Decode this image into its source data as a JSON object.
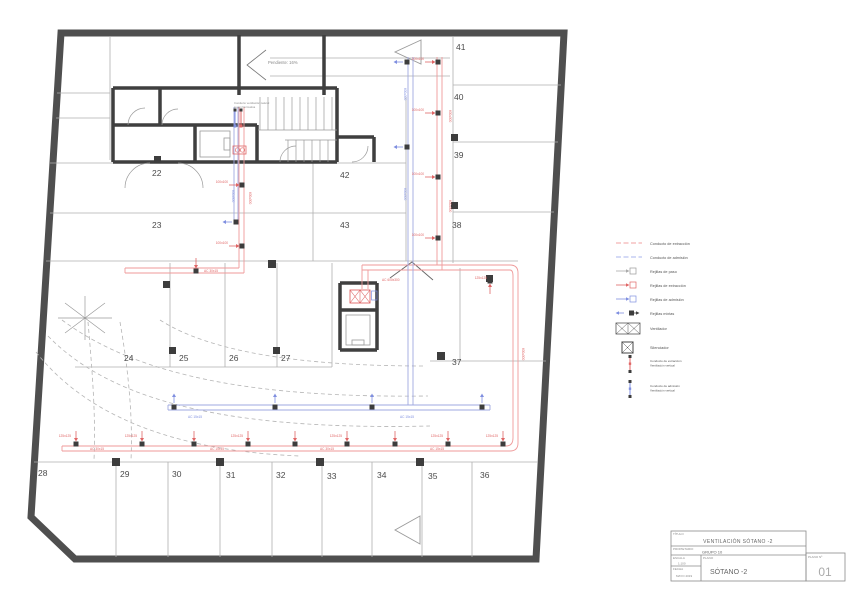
{
  "drawing": {
    "spaces": [
      "22",
      "23",
      "24",
      "25",
      "26",
      "27",
      "28",
      "29",
      "30",
      "31",
      "32",
      "33",
      "34",
      "35",
      "36",
      "37",
      "38",
      "39",
      "40",
      "41",
      "42",
      "43"
    ],
    "ramp_label": "Pendiente: 16%",
    "shaft_note_line1": "Conducto ventilación natural",
    "shaft_note_line2": "según Normativa"
  },
  "duct_labels": {
    "size_600": "600x300",
    "size_100": "100x100",
    "size_125": "125x125",
    "ac_600": "AC 600x300",
    "ac_30": "AC 30x15",
    "ac_15": "AC 15x15"
  },
  "legend": {
    "items": [
      {
        "label": "Conducto de extracción"
      },
      {
        "label": "Conducto de admisión"
      },
      {
        "label": "Rejillas de paso"
      },
      {
        "label": "Rejillas de extracción"
      },
      {
        "label": "Rejillas de admisión"
      },
      {
        "label": "Rejillas mixtas"
      },
      {
        "label": "Ventilador"
      },
      {
        "label": "Silenciador"
      },
      {
        "label": "Conducto de extracción",
        "label2": "Ventilación vertical"
      },
      {
        "label": "Conducto de admisión",
        "label2": "Ventilación vertical"
      }
    ]
  },
  "titleblock": {
    "titulo_label": "TÍTULO",
    "titulo": "VENTILACIÓN SÓTANO -2",
    "propietario_label": "PROPIETARIO",
    "propietario": "GRUPO 10",
    "escala_label": "ESCALA",
    "escala": "1:100",
    "fecha_label": "FECHA",
    "fecha": "MAYO 2019",
    "plano_label": "PLANO",
    "plano": "SÓTANO -2",
    "plano_num_label": "PLANO Nº",
    "plano_num": "01"
  },
  "colors": {
    "extraction": "#e06666",
    "admission": "#7f8fe0",
    "wall": "#4f4f4f"
  }
}
